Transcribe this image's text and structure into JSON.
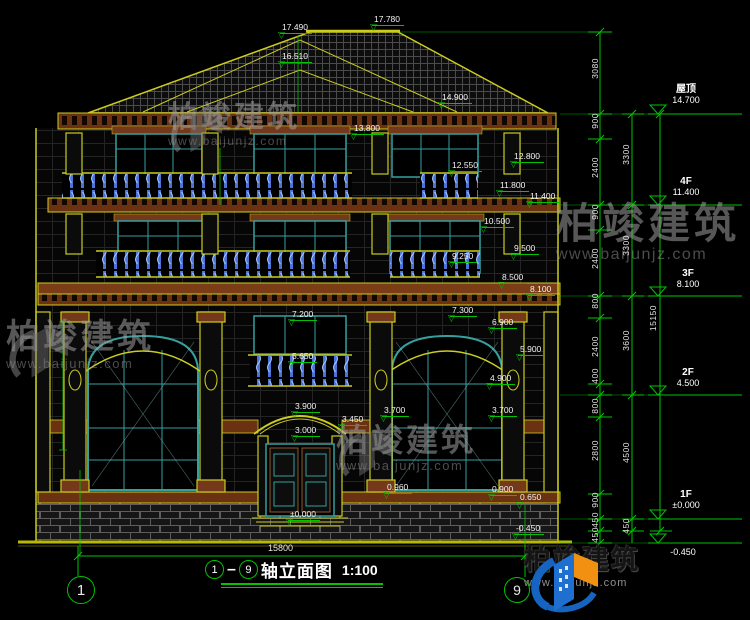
{
  "drawing": {
    "title": "轴立面图",
    "axis_start": "1",
    "axis_end": "9",
    "scale": "1:100",
    "overall_width_dim": "15800",
    "overall_height_dim": "15150"
  },
  "floor_levels": [
    {
      "label": "屋顶",
      "value": "14.700"
    },
    {
      "label": "4F",
      "value": "11.400"
    },
    {
      "label": "3F",
      "value": "8.100"
    },
    {
      "label": "2F",
      "value": "4.500"
    },
    {
      "label": "1F",
      "value": "±0.000"
    },
    {
      "label": "",
      "value": "-0.450"
    }
  ],
  "right_segments": [
    "3080",
    "900",
    "2400",
    "900",
    "2400",
    "800",
    "2400",
    "400",
    "800",
    "2800",
    "900",
    "450",
    "450"
  ],
  "floor_totals": [
    "3300",
    "3300",
    "3600",
    "4500",
    "450"
  ],
  "elevation_marks": [
    "17.780",
    "17.490",
    "16.510",
    "14.900",
    "13.800",
    "12.800",
    "12.550",
    "11.800",
    "11.400",
    "10.500",
    "9.500",
    "9.250",
    "8.500",
    "8.100",
    "7.300",
    "7.200",
    "6.900",
    "5.900",
    "5.650",
    "4.900",
    "3.900",
    "3.700",
    "3.700",
    "3.450",
    "3.000",
    "0.960",
    "0.900",
    "0.650",
    "±0.000",
    "-0.450"
  ],
  "watermark": {
    "brand": "柏竣建筑",
    "url": "www.baijunjz.com"
  },
  "logo": {
    "brand": "柏竣建筑",
    "url": "www.baijunjz.com"
  }
}
